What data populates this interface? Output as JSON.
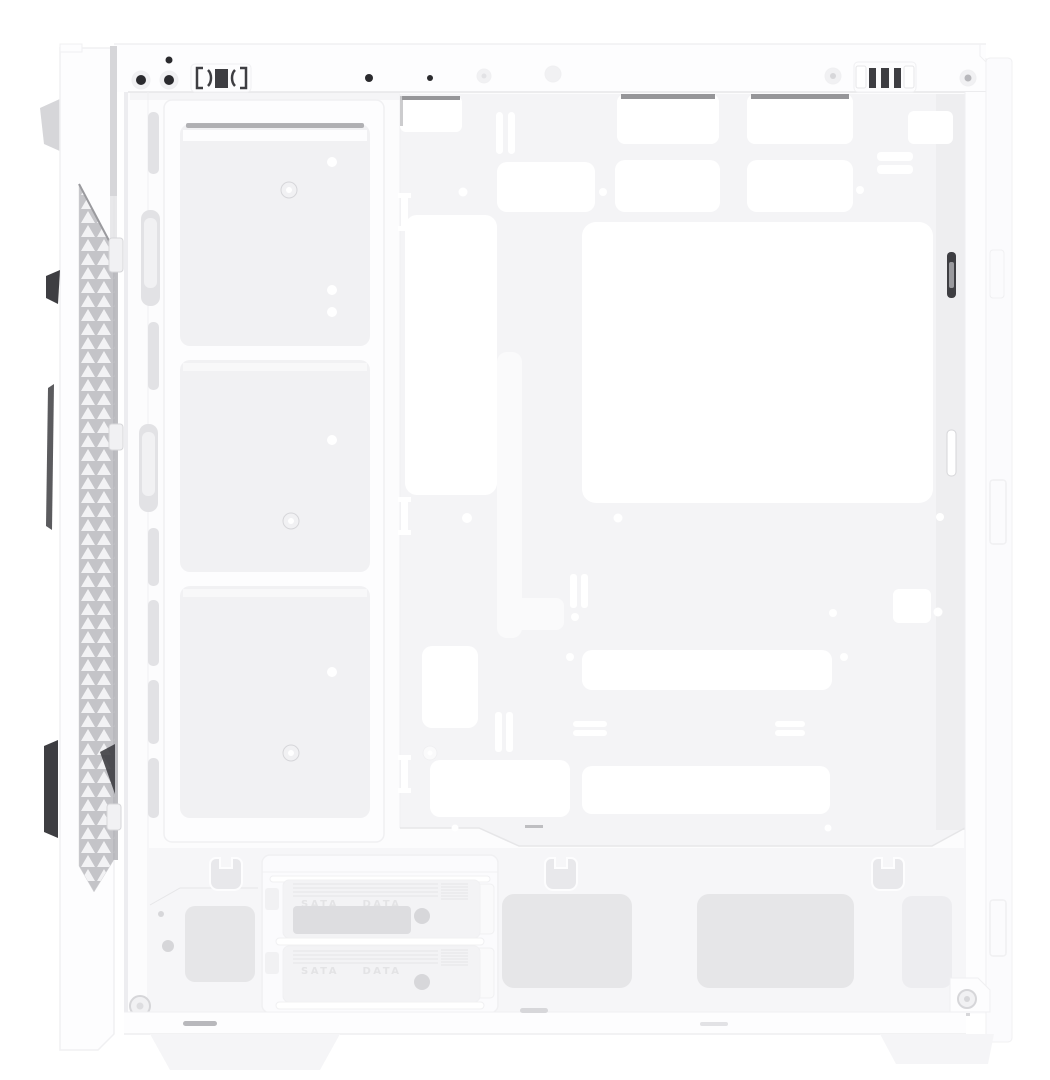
{
  "scene": {
    "description": "Product photo of a white mid-tower ATX PC case, viewed from the left side with the side panel removed, showing an empty interior: front triangular-mesh vent strip, front fan and radiator mounting bracket with three openings, motherboard tray with CPU-cooler cutout and cable-routing cutouts, rear rail, and a bottom hard-drive cage with two sliding trays above gray vent pads.",
    "background": "#ffffff"
  },
  "colors": {
    "background": "#ffffff",
    "case-body": "#fdfdfe",
    "interior": "#fcfcfd",
    "tray": "#f4f4f6",
    "tray-strip": "#ededf0",
    "cutout": "#ffffff",
    "opening": "#f1f1f3",
    "slot": "#e2e2e5",
    "mat": "#e6e6e8",
    "floor": "#f5f5f7",
    "cage": "#fbfbfd",
    "hdd-tray": "#f3f3f5",
    "tray-window": "#dddde0",
    "hook": "#e8e8eb",
    "emboss": "#e3e3e5",
    "ridge": "#e4e4e6",
    "edge": "#e6e6e8",
    "faint": "#f0f0f2",
    "mesh-bg": "#c4c4c8",
    "mesh-tri": "#f2f2f4",
    "dark": "#3e3e42",
    "hole": "#2b2b2e",
    "metal": "#9a9a9e",
    "shadow-bar": "#b8b8bc",
    "cut-edge": "#7c7c80",
    "panel-shadow": "#d6d6d9",
    "dot-gray": "#d7d7da",
    "light": "#fafafb"
  },
  "hdd_cage": {
    "tray1": {
      "label_left": "SATA",
      "label_right": "DATA"
    },
    "tray2": {
      "label_left": "SATA",
      "label_right": "DATA"
    }
  }
}
